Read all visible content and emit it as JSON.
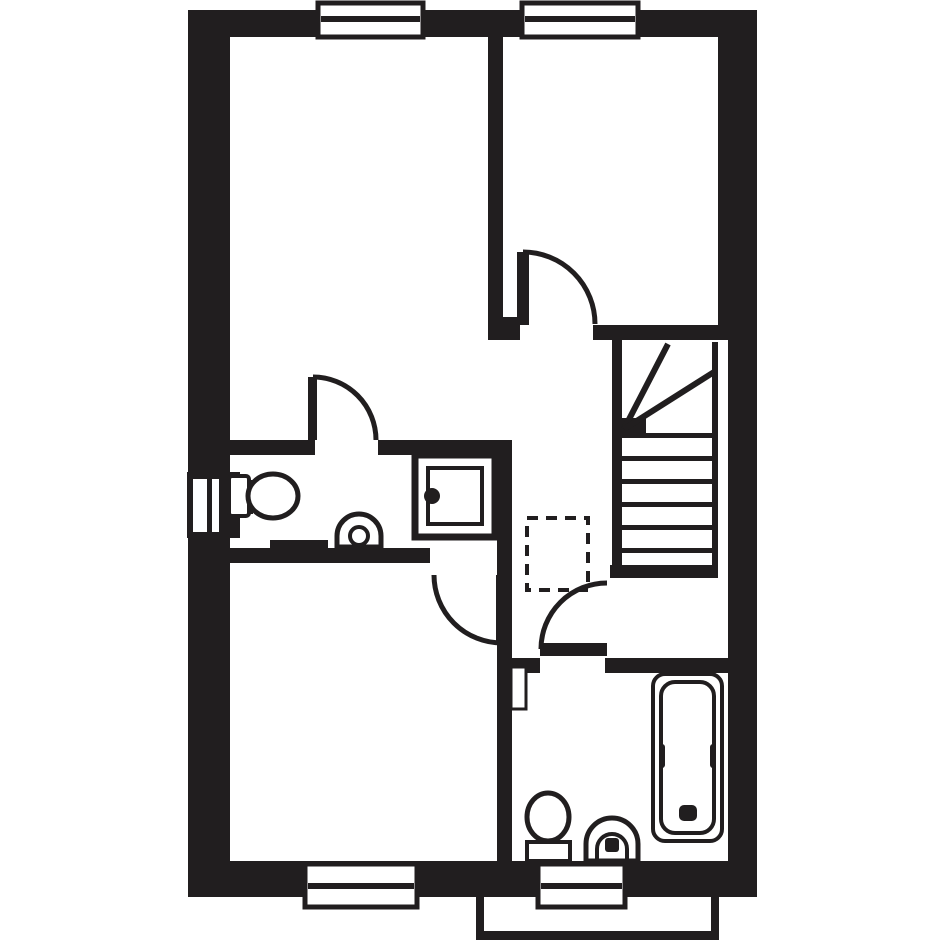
{
  "canvas": {
    "width": 945,
    "height": 945,
    "background": "#ffffff",
    "ink": "#211e1f"
  },
  "floorplan": {
    "layers": [
      {
        "name": "walls",
        "shapes": [
          {
            "n": "wall-top-exterior",
            "t": "rect",
            "x": 188,
            "y": 10,
            "w": 569,
            "h": 27,
            "f": "ink"
          },
          {
            "n": "wall-left-exterior",
            "t": "rect",
            "x": 188,
            "y": 10,
            "w": 42,
            "h": 887,
            "f": "ink"
          },
          {
            "n": "wall-right-exterior-upper",
            "t": "rect",
            "x": 718,
            "y": 10,
            "w": 39,
            "h": 330,
            "f": "ink"
          },
          {
            "n": "wall-right-exterior-lower",
            "t": "rect",
            "x": 728,
            "y": 340,
            "w": 29,
            "h": 557,
            "f": "ink"
          },
          {
            "n": "wall-bottom-exterior",
            "t": "rect",
            "x": 188,
            "y": 861,
            "w": 569,
            "h": 36,
            "f": "ink"
          },
          {
            "n": "wall-bedroom-divider",
            "t": "rect",
            "x": 488,
            "y": 37,
            "w": 15,
            "h": 280,
            "f": "ink"
          },
          {
            "n": "wall-jamb-bedroom2-door",
            "t": "rect",
            "x": 488,
            "y": 317,
            "w": 32,
            "h": 23,
            "f": "ink"
          },
          {
            "n": "wall-bedroom2-landing",
            "t": "rect",
            "x": 593,
            "y": 325,
            "w": 137,
            "h": 15,
            "f": "ink"
          },
          {
            "n": "wall-ensuite-top-left",
            "t": "rect",
            "x": 230,
            "y": 440,
            "w": 85,
            "h": 15,
            "f": "ink"
          },
          {
            "n": "wall-ensuite-top-right",
            "t": "rect",
            "x": 378,
            "y": 440,
            "w": 134,
            "h": 15,
            "f": "ink"
          },
          {
            "n": "wall-ensuite-right",
            "t": "rect",
            "x": 497,
            "y": 440,
            "w": 15,
            "h": 123,
            "f": "ink"
          },
          {
            "n": "wall-ensuite-bottom",
            "t": "rect",
            "x": 230,
            "y": 548,
            "w": 200,
            "h": 15,
            "f": "ink"
          },
          {
            "n": "wall-jamb-bedroom3-door",
            "t": "rect",
            "x": 497,
            "y": 560,
            "w": 15,
            "h": 15,
            "f": "ink"
          },
          {
            "n": "wall-bedroom3-right",
            "t": "rect",
            "x": 497,
            "y": 575,
            "w": 15,
            "h": 286,
            "f": "ink"
          },
          {
            "n": "wall-bathroom-top-left",
            "t": "rect",
            "x": 512,
            "y": 658,
            "w": 28,
            "h": 15,
            "f": "ink"
          },
          {
            "n": "wall-bathroom-top-right",
            "t": "rect",
            "x": 605,
            "y": 658,
            "w": 125,
            "h": 15,
            "f": "ink"
          },
          {
            "n": "wall-stair-bottom",
            "t": "rect",
            "x": 610,
            "y": 565,
            "w": 108,
            "h": 13,
            "f": "ink"
          },
          {
            "n": "wall-stairwell-left",
            "t": "rect",
            "x": 612,
            "y": 340,
            "w": 10,
            "h": 225,
            "f": "ink"
          }
        ]
      },
      {
        "name": "windows",
        "shapes": [
          {
            "n": "window-top-left-frame",
            "t": "rect",
            "x": 318,
            "y": 3,
            "w": 105,
            "h": 34,
            "f": "white",
            "s": "ink",
            "sw": 5
          },
          {
            "n": "window-top-left-mullion",
            "t": "rect",
            "x": 321,
            "y": 16,
            "w": 99,
            "h": 6,
            "f": "ink"
          },
          {
            "n": "window-top-right-frame",
            "t": "rect",
            "x": 522,
            "y": 3,
            "w": 116,
            "h": 34,
            "f": "white",
            "s": "ink",
            "sw": 5
          },
          {
            "n": "window-top-right-mullion",
            "t": "rect",
            "x": 525,
            "y": 16,
            "w": 110,
            "h": 6,
            "f": "ink"
          },
          {
            "n": "window-bottom-left-frame",
            "t": "rect",
            "x": 305,
            "y": 864,
            "w": 112,
            "h": 43,
            "f": "white",
            "s": "ink",
            "sw": 5
          },
          {
            "n": "window-bottom-left-mullion",
            "t": "rect",
            "x": 308,
            "y": 883,
            "w": 106,
            "h": 6,
            "f": "ink"
          },
          {
            "n": "window-bottom-right-frame",
            "t": "rect",
            "x": 538,
            "y": 864,
            "w": 87,
            "h": 43,
            "f": "white",
            "s": "ink",
            "sw": 5
          },
          {
            "n": "window-bottom-right-mullion",
            "t": "rect",
            "x": 541,
            "y": 883,
            "w": 81,
            "h": 6,
            "f": "ink"
          },
          {
            "n": "window-left-box",
            "t": "rect",
            "x": 187,
            "y": 472,
            "w": 53,
            "h": 66,
            "f": "ink"
          },
          {
            "n": "window-left-pane-outer",
            "t": "rect",
            "x": 193,
            "y": 479,
            "w": 14,
            "h": 53,
            "f": "white"
          },
          {
            "n": "window-left-pane-inner",
            "t": "rect",
            "x": 212,
            "y": 479,
            "w": 7,
            "h": 53,
            "f": "white"
          }
        ]
      },
      {
        "name": "stairs",
        "shapes": [
          {
            "n": "stair-tread-1",
            "t": "rect",
            "x": 622,
            "y": 433,
            "w": 90,
            "h": 5,
            "f": "ink"
          },
          {
            "n": "stair-tread-2",
            "t": "rect",
            "x": 622,
            "y": 456,
            "w": 90,
            "h": 5,
            "f": "ink"
          },
          {
            "n": "stair-tread-3",
            "t": "rect",
            "x": 622,
            "y": 479,
            "w": 90,
            "h": 5,
            "f": "ink"
          },
          {
            "n": "stair-tread-4",
            "t": "rect",
            "x": 622,
            "y": 502,
            "w": 90,
            "h": 5,
            "f": "ink"
          },
          {
            "n": "stair-tread-5",
            "t": "rect",
            "x": 622,
            "y": 525,
            "w": 90,
            "h": 5,
            "f": "ink"
          },
          {
            "n": "stair-tread-6",
            "t": "rect",
            "x": 622,
            "y": 548,
            "w": 90,
            "h": 5,
            "f": "ink"
          },
          {
            "n": "stair-stringer-right",
            "t": "rect",
            "x": 712,
            "y": 342,
            "w": 6,
            "h": 223,
            "f": "ink"
          },
          {
            "n": "stair-newel-block",
            "t": "rect",
            "x": 612,
            "y": 418,
            "w": 34,
            "h": 20,
            "f": "ink"
          },
          {
            "n": "stair-winder-line-1",
            "t": "line",
            "x1": 624,
            "y1": 429,
            "x2": 668,
            "y2": 344,
            "s": "ink",
            "sw": 6
          },
          {
            "n": "stair-winder-line-2",
            "t": "line",
            "x1": 624,
            "y1": 429,
            "x2": 714,
            "y2": 372,
            "s": "ink",
            "sw": 6
          }
        ]
      },
      {
        "name": "storage",
        "shapes": [
          {
            "n": "cupboard-dashed-outline",
            "t": "rect",
            "x": 527,
            "y": 518,
            "w": 61,
            "h": 72,
            "f": "none",
            "s": "ink",
            "sw": 4,
            "dash": "11 8"
          }
        ]
      },
      {
        "name": "doors",
        "shapes": [
          {
            "n": "ensuite-door-leaf",
            "t": "rect",
            "x": 308,
            "y": 377,
            "w": 9,
            "h": 63,
            "f": "ink"
          },
          {
            "n": "ensuite-door-swing",
            "t": "path",
            "d": "M 313 377 A 63 63 0 0 1 376 440",
            "f": "none",
            "s": "ink",
            "sw": 5
          },
          {
            "n": "bedroom2-door-leaf",
            "t": "rect",
            "x": 517,
            "y": 252,
            "w": 12,
            "h": 73,
            "f": "ink"
          },
          {
            "n": "bedroom2-door-swing",
            "t": "path",
            "d": "M 523 252 A 72 72 0 0 1 595 324",
            "f": "none",
            "s": "ink",
            "sw": 5
          },
          {
            "n": "bedroom3-door-leaf",
            "t": "rect",
            "x": 496,
            "y": 575,
            "w": 13,
            "h": 70,
            "f": "ink"
          },
          {
            "n": "bedroom3-door-swing",
            "t": "path",
            "d": "M 434 575 A 68 68 0 0 0 502 643",
            "f": "none",
            "s": "ink",
            "sw": 5
          },
          {
            "n": "bathroom-door-leaf",
            "t": "rect",
            "x": 540,
            "y": 643,
            "w": 67,
            "h": 13,
            "f": "ink"
          },
          {
            "n": "bathroom-door-swing",
            "t": "path",
            "d": "M 541 649 A 66 66 0 0 1 607 583",
            "f": "none",
            "s": "ink",
            "sw": 5
          }
        ]
      },
      {
        "name": "ensuite-fixtures",
        "shapes": [
          {
            "n": "shower-tray-outer",
            "t": "rect",
            "x": 415,
            "y": 455,
            "w": 80,
            "h": 82,
            "f": "none",
            "s": "ink",
            "sw": 7
          },
          {
            "n": "shower-tray-inner",
            "t": "rect",
            "x": 428,
            "y": 468,
            "w": 54,
            "h": 56,
            "f": "none",
            "s": "ink",
            "sw": 4
          },
          {
            "n": "shower-drain-dot",
            "t": "circle",
            "cx": 432,
            "cy": 496,
            "r": 8,
            "f": "ink"
          },
          {
            "n": "ensuite-toilet-cistern",
            "t": "rect",
            "x": 229,
            "y": 476,
            "w": 20,
            "h": 40,
            "rx": 3,
            "f": "white",
            "s": "ink",
            "sw": 4
          },
          {
            "n": "ensuite-toilet-seat-hinge",
            "t": "rect",
            "x": 247,
            "y": 480,
            "w": 6,
            "h": 34,
            "f": "ink"
          },
          {
            "n": "ensuite-toilet-bowl",
            "t": "ellipse",
            "cx": 273,
            "cy": 496,
            "rx": 25,
            "ry": 22,
            "f": "white",
            "s": "ink",
            "sw": 5
          },
          {
            "n": "ensuite-radiator",
            "t": "rect",
            "x": 270,
            "y": 540,
            "w": 58,
            "h": 8,
            "f": "ink"
          },
          {
            "n": "ensuite-basin-outer",
            "t": "path",
            "d": "M 337 547 L 337 536 A 22 22 0 0 1 381 536 L 381 547 Z",
            "f": "white",
            "s": "ink",
            "sw": 5
          },
          {
            "n": "ensuite-basin-bowl",
            "t": "circle",
            "cx": 359,
            "cy": 536,
            "r": 9,
            "f": "white",
            "s": "ink",
            "sw": 4
          }
        ]
      },
      {
        "name": "bathroom-fixtures",
        "shapes": [
          {
            "n": "bath-outer",
            "t": "rect",
            "x": 653,
            "y": 674,
            "w": 69,
            "h": 167,
            "rx": 12,
            "f": "white",
            "s": "ink",
            "sw": 4
          },
          {
            "n": "bath-inner",
            "t": "rect",
            "x": 661,
            "y": 682,
            "w": 53,
            "h": 151,
            "rx": 14,
            "f": "none",
            "s": "ink",
            "sw": 4
          },
          {
            "n": "bath-waist-left",
            "t": "rect",
            "x": 659,
            "y": 744,
            "w": 6,
            "h": 24,
            "rx": 3,
            "f": "ink"
          },
          {
            "n": "bath-waist-right",
            "t": "rect",
            "x": 710,
            "y": 744,
            "w": 6,
            "h": 24,
            "rx": 3,
            "f": "ink"
          },
          {
            "n": "bath-plug",
            "t": "rect",
            "x": 679,
            "y": 805,
            "w": 18,
            "h": 16,
            "rx": 5,
            "f": "ink"
          },
          {
            "n": "bathroom-radiator",
            "t": "rect",
            "x": 511,
            "y": 667,
            "w": 15,
            "h": 42,
            "f": "white",
            "s": "ink",
            "sw": 3
          },
          {
            "n": "bathroom-toilet-cistern",
            "t": "rect",
            "x": 527,
            "y": 842,
            "w": 43,
            "h": 19,
            "f": "white",
            "s": "ink",
            "sw": 4
          },
          {
            "n": "bathroom-toilet-bowl",
            "t": "ellipse",
            "cx": 548,
            "cy": 817,
            "rx": 21,
            "ry": 24,
            "f": "white",
            "s": "ink",
            "sw": 5
          },
          {
            "n": "bathroom-basin-outer",
            "t": "path",
            "d": "M 586 861 L 586 844 A 26 26 0 0 1 638 844 L 638 861 Z",
            "f": "white",
            "s": "ink",
            "sw": 5
          },
          {
            "n": "bathroom-basin-inner",
            "t": "path",
            "d": "M 597 861 L 597 849 A 15 15 0 0 1 627 849 L 627 861",
            "f": "none",
            "s": "ink",
            "sw": 4
          },
          {
            "n": "bathroom-basin-tap",
            "t": "rect",
            "x": 605,
            "y": 838,
            "w": 14,
            "h": 14,
            "rx": 3,
            "f": "ink"
          }
        ]
      },
      {
        "name": "porch",
        "shapes": [
          {
            "n": "porch-step-left",
            "t": "rect",
            "x": 476,
            "y": 897,
            "w": 8,
            "h": 43,
            "f": "ink"
          },
          {
            "n": "porch-step-bottom",
            "t": "rect",
            "x": 476,
            "y": 931,
            "w": 243,
            "h": 9,
            "f": "ink"
          },
          {
            "n": "porch-step-right",
            "t": "rect",
            "x": 711,
            "y": 897,
            "w": 8,
            "h": 43,
            "f": "ink"
          }
        ]
      }
    ]
  }
}
